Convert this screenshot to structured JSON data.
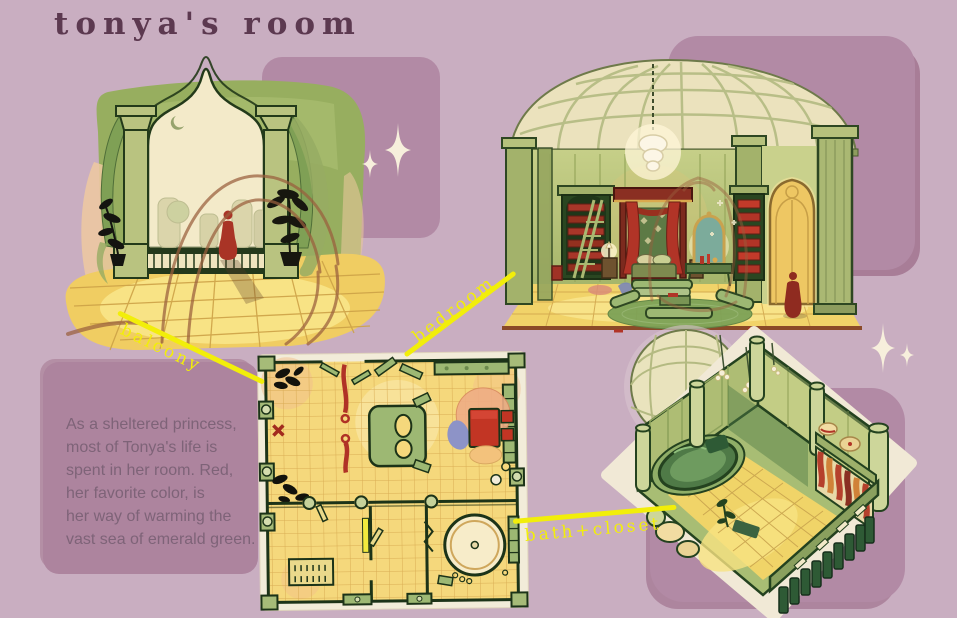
{
  "title": "tonya's room",
  "description_lines": [
    "As a sheltered princess,",
    "most of Tonya's life is",
    "spent in her room. Red,",
    "her favorite color, is",
    "her way of warming the",
    "vast sea of emerald green."
  ],
  "callouts": {
    "balcony": "balcony",
    "bedroom": "bedroom",
    "bath_closet": "bath+closet"
  },
  "icons": {
    "sparkles_upper": "sparkle-icon",
    "sparkles_right": "sparkle-icon"
  },
  "colors": {
    "page_background": "#c9aec1",
    "backdrop_panel": "#b28aa5",
    "text_panel": "#ad849e",
    "title_text": "#5c3950",
    "body_text": "#7e6378",
    "callout_yellow": "#f2ee0a",
    "sparkle_cream": "#f7efdc",
    "art_green_light": "#aebd76",
    "art_green_dark": "#2e4722",
    "art_cream": "#f3eac9",
    "art_floor_yellow": "#f1d369",
    "art_accent_red": "#b13427",
    "art_sketch_brown": "#9a5f3d"
  }
}
